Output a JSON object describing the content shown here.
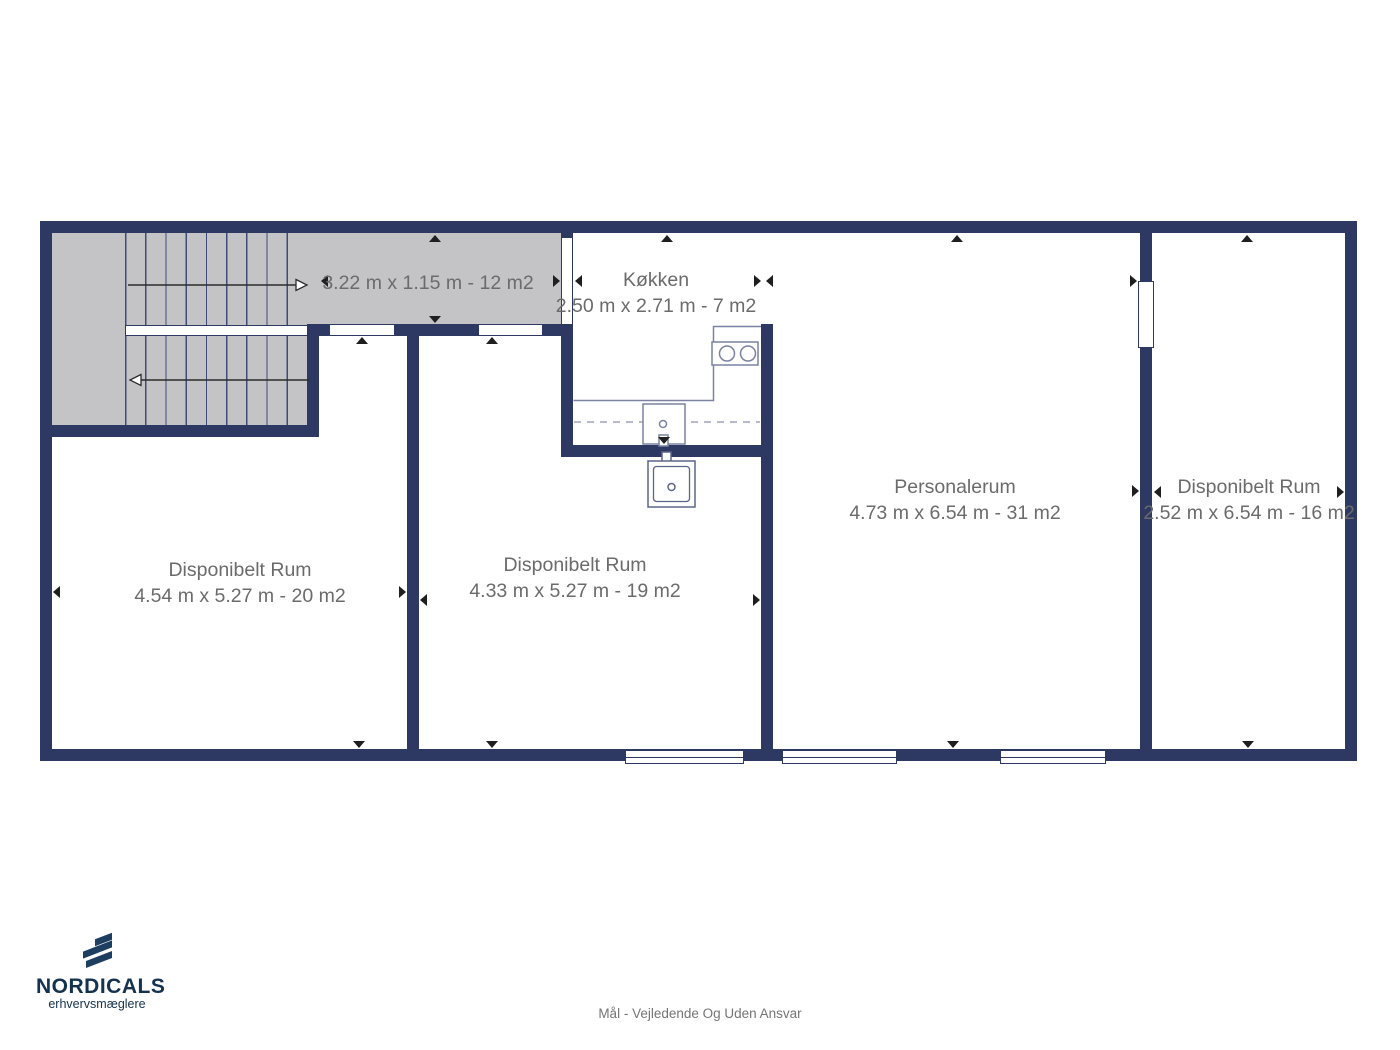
{
  "plan": {
    "corridor": {
      "dims": "3.22 m x 1.15 m - 12 m2"
    },
    "kitchen": {
      "name": "Køkken",
      "dims": "2.50 m x 2.71 m - 7 m2"
    },
    "room_left": {
      "name": "Disponibelt Rum",
      "dims": "4.54 m x 5.27 m - 20 m2"
    },
    "room_middle": {
      "name": "Disponibelt Rum",
      "dims": "4.33 m x 5.27 m - 19 m2"
    },
    "staff_room": {
      "name": "Personalerum",
      "dims": "4.73 m x 6.54 m - 31 m2"
    },
    "room_right": {
      "name": "Disponibelt Rum",
      "dims": "2.52 m x 6.54 m - 16 m2"
    }
  },
  "branding": {
    "brand": "NORDICALS",
    "tagline": "erhvervsmæglere"
  },
  "footer": {
    "disclaimer": "Mål - Vejledende Og Uden Ansvar"
  },
  "colors": {
    "wall": "#2d3963",
    "stair_fill": "#c4c4c6",
    "label_text": "#6b6b6b",
    "brand_navy": "#15324f"
  }
}
